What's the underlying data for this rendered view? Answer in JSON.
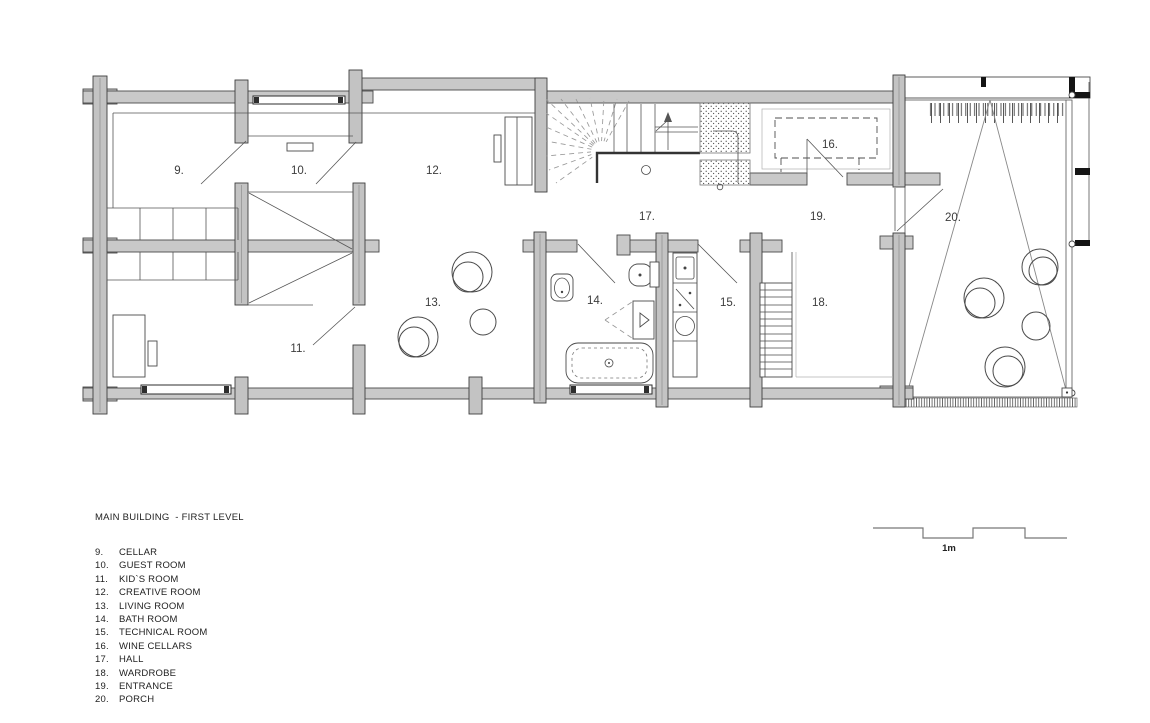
{
  "title": "MAIN BUILDING  - FIRST LEVEL",
  "scale": {
    "label": "1m"
  },
  "rooms": [
    {
      "num": "9.",
      "name": "CELLAR"
    },
    {
      "num": "10.",
      "name": "GUEST ROOM"
    },
    {
      "num": "11.",
      "name": "KID`S ROOM"
    },
    {
      "num": "12.",
      "name": "CREATIVE ROOM"
    },
    {
      "num": "13.",
      "name": "LIVING ROOM"
    },
    {
      "num": "14.",
      "name": "BATH ROOM"
    },
    {
      "num": "15.",
      "name": "TECHNICAL ROOM"
    },
    {
      "num": "16.",
      "name": "WINE CELLARS"
    },
    {
      "num": "17.",
      "name": "HALL"
    },
    {
      "num": "18.",
      "name": "WARDROBE"
    },
    {
      "num": "19.",
      "name": "ENTRANCE"
    },
    {
      "num": "20.",
      "name": "PORCH"
    }
  ],
  "colors": {
    "wall_fill": "#c9c9c9",
    "wall_stroke": "#4a4a4a",
    "post_fill": "#c3c3c3",
    "line_dark": "#333333",
    "line_mid": "#555555",
    "line_light": "#999999",
    "label_color": "#3c3c3c",
    "background": "#ffffff"
  }
}
